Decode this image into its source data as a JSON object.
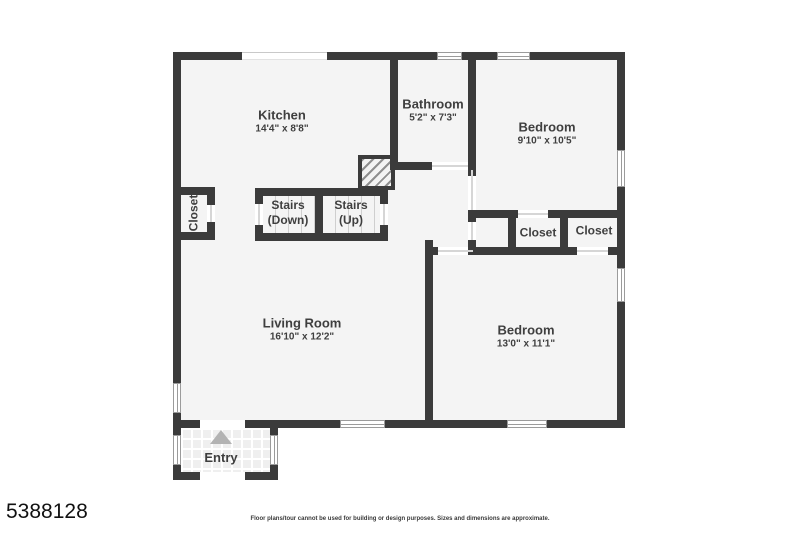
{
  "page": {
    "listing_id": "5388128",
    "disclaimer": "Floor plans/tour cannot be used for building or design purposes. Sizes and dimensions are approximate."
  },
  "colors": {
    "wall": "#3b3b3b",
    "floor": "#f4f4f4",
    "label_text": "#3f3f3f",
    "north_arrow": "#b3b3b3"
  },
  "rooms": {
    "kitchen": {
      "name": "Kitchen",
      "dims": "14'4\" x 8'8\""
    },
    "bathroom": {
      "name": "Bathroom",
      "dims": "5'2\" x 7'3\""
    },
    "bedroom_top": {
      "name": "Bedroom",
      "dims": "9'10\" x 10'5\""
    },
    "living_room": {
      "name": "Living Room",
      "dims": "16'10\" x 12'2\""
    },
    "bedroom_bottom": {
      "name": "Bedroom",
      "dims": "13'0\" x 11'1\""
    },
    "closet_left": {
      "name": "Closet"
    },
    "closet_middle": {
      "name": "Closet"
    },
    "closet_right": {
      "name": "Closet"
    },
    "stairs_down": {
      "line1": "Stairs",
      "line2": "(Down)"
    },
    "stairs_up": {
      "line1": "Stairs",
      "line2": "(Up)"
    },
    "entry": {
      "name": "Entry"
    }
  }
}
